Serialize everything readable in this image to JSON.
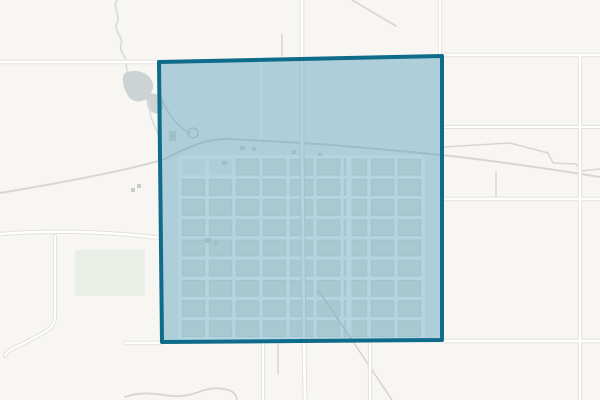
{
  "window": {
    "width": 600,
    "height": 400
  },
  "map": {
    "colors": {
      "background": "#f7f6f3",
      "road_casing": "#e4e1dc",
      "road_core": "#ffffff",
      "minor_road": "#d9d6d1",
      "street": "#ffffff",
      "block_fill": "#edebe6",
      "block_stroke": "#e0ddd7",
      "water_fill": "#cdd2d3",
      "water_line": "#d8dcdc",
      "park_fill": "#e9eee6",
      "building": "#cbcbc7",
      "town_building": "#dfdcd6"
    },
    "selection": {
      "fill": "#4999b8",
      "fill_opacity": 0.42,
      "stroke": "#0e6b8a",
      "stroke_width": 4,
      "points": "159,62 442,56 442,340 162,342"
    },
    "major_roads": [
      {
        "d": "M0,62 L159,62",
        "w": 2.6
      },
      {
        "d": "M442,55 L600,55",
        "w": 2.6
      },
      {
        "d": "M442,127 L600,127",
        "w": 2
      },
      {
        "d": "M440,199 L600,199",
        "w": 2.6
      },
      {
        "d": "M444,341 L600,341",
        "w": 2.8
      },
      {
        "d": "M125,343 L160,343",
        "w": 2.4
      },
      {
        "d": "M302,0 L302,142 L304,341 L305,400",
        "w": 2.8
      },
      {
        "d": "M580,57 L580,400",
        "w": 2.4
      },
      {
        "d": "M440,0 L440,55",
        "w": 2.4
      },
      {
        "d": "M0,234 Q80,228 161,238",
        "w": 2.4
      },
      {
        "d": "M55,236 L55,316 C55,330 42,333 30,340 C16,348 8,349 5,356",
        "w": 2.2
      },
      {
        "d": "M263,342 L263,400",
        "w": 2.2
      },
      {
        "d": "M370,342 L370,400",
        "w": 2.2
      }
    ],
    "minor_roads": [
      {
        "d": "M0,193 C60,183 120,172 162,160 C190,147 205,138 232,139 L302,143 C350,146 400,151 442,155 C495,161 550,169 600,177",
        "w": 2
      },
      {
        "d": "M352,0 L396,26",
        "w": 1.6
      },
      {
        "d": "M318,290 L352,340 L392,400",
        "w": 1.6
      },
      {
        "d": "M443,147 L510,143 L548,153 L553,163 L576,164 L581,171 L600,169",
        "w": 1.5
      },
      {
        "d": "M496,172 L496,199",
        "w": 1.5
      },
      {
        "d": "M278,343 L278,374",
        "w": 1.5
      },
      {
        "d": "M282,34 L282,56",
        "w": 1.5
      },
      {
        "d": "M125,397 C148,389 162,397 180,396 C200,395 203,386 224,389 C234,391 236,394 237,400",
        "w": 1.8
      },
      {
        "d": "M161,97 C168,114 176,126 190,133",
        "w": 1.6
      },
      {
        "d": "M188,133 a5,5 0 1 0 10,0 a5,5 0 1 0 -10,0",
        "w": 1.6
      }
    ],
    "streets": [
      {
        "d": "M261,58 L261,140",
        "w": 2.5
      },
      {
        "d": "M349,158 L349,339",
        "w": 5
      }
    ],
    "grid": {
      "x": 180,
      "y": 157,
      "cols": 9,
      "rows": 9,
      "cw": 27,
      "ch": 20.2,
      "street_w": 4,
      "skip": [
        [
          0,
          0
        ],
        [
          1,
          0
        ]
      ]
    },
    "water": {
      "lines": [
        {
          "d": "M117,0 C112,8 121,15 117,23 C113,31 124,37 121,45 C119,53 128,57 126,64 L127,71",
          "w": 1.8
        },
        {
          "d": "M146,99 C149,103 151,107 150,112",
          "w": 1.5
        },
        {
          "d": "M150,112 C151,120 156,129 161,139",
          "w": 1.5
        }
      ],
      "bodies": [
        "M125,73 C134,68 148,72 152,81 C155,88 151,95 146,99 C139,104 130,101 127,94 C123,87 121,77 125,73 Z",
        "M150,94 C156,92 162,97 163,104 C164,111 159,115 154,113 C149,111 146,106 147,100 C147,97 148,95 150,94 Z"
      ]
    },
    "park": {
      "x": 75,
      "y": 250,
      "w": 70,
      "h": 46
    },
    "buildings_outside": [
      [
        131,
        188,
        4,
        4
      ],
      [
        137,
        184,
        4,
        4
      ]
    ],
    "buildings_town": [
      [
        169,
        131,
        7,
        10
      ],
      [
        240,
        146,
        5,
        4
      ],
      [
        252,
        147,
        4,
        4
      ],
      [
        292,
        150,
        4,
        4
      ],
      [
        222,
        161,
        5,
        4
      ],
      [
        318,
        153,
        4,
        3
      ],
      [
        205,
        238,
        6,
        5
      ],
      [
        214,
        241,
        4,
        4
      ]
    ]
  }
}
